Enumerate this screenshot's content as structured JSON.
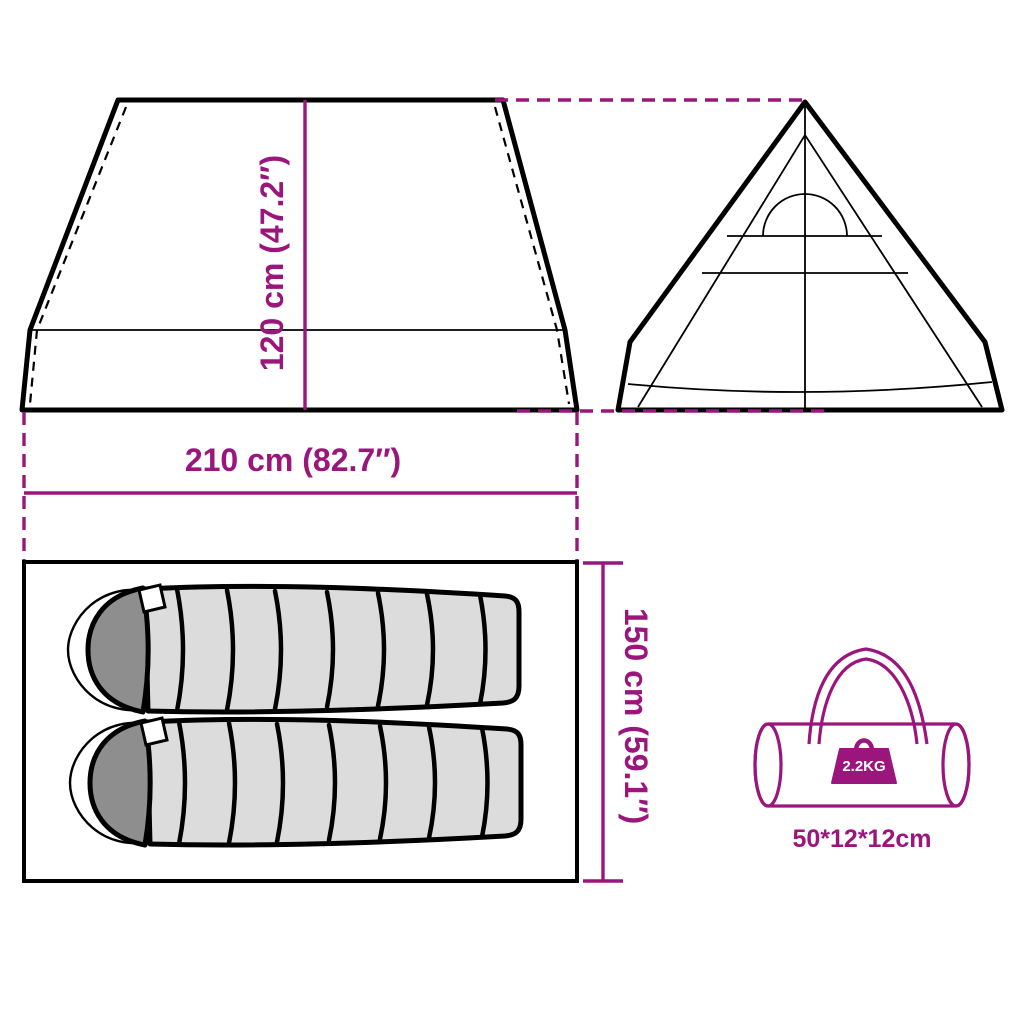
{
  "title": "Tent dimensions product diagram",
  "colors": {
    "accent": "#9A167C",
    "line": "#000000",
    "bag-body": "#DCDCDC",
    "bag-hood": "#8E8E8E"
  },
  "dimension_labels": {
    "height": "120 cm (47.2″)",
    "width": "210 cm (82.7″)",
    "inner_length": "150 cm (59.1″)"
  },
  "carry_bag": {
    "weight": "2.2KG",
    "size": "50*12*12cm"
  },
  "icons": {
    "tent_side_view": "trapezoid tent silhouette, side elevation",
    "tent_front_view": "triangular tipi tent silhouette with door arch, front elevation",
    "floor_plan": "rectangular groundsheet outline",
    "sleeping_bag": "segmented mummy sleeping bag, top view",
    "carry_bag": "cylindrical duffel carry bag with handle",
    "weight": "kettle weight block"
  }
}
